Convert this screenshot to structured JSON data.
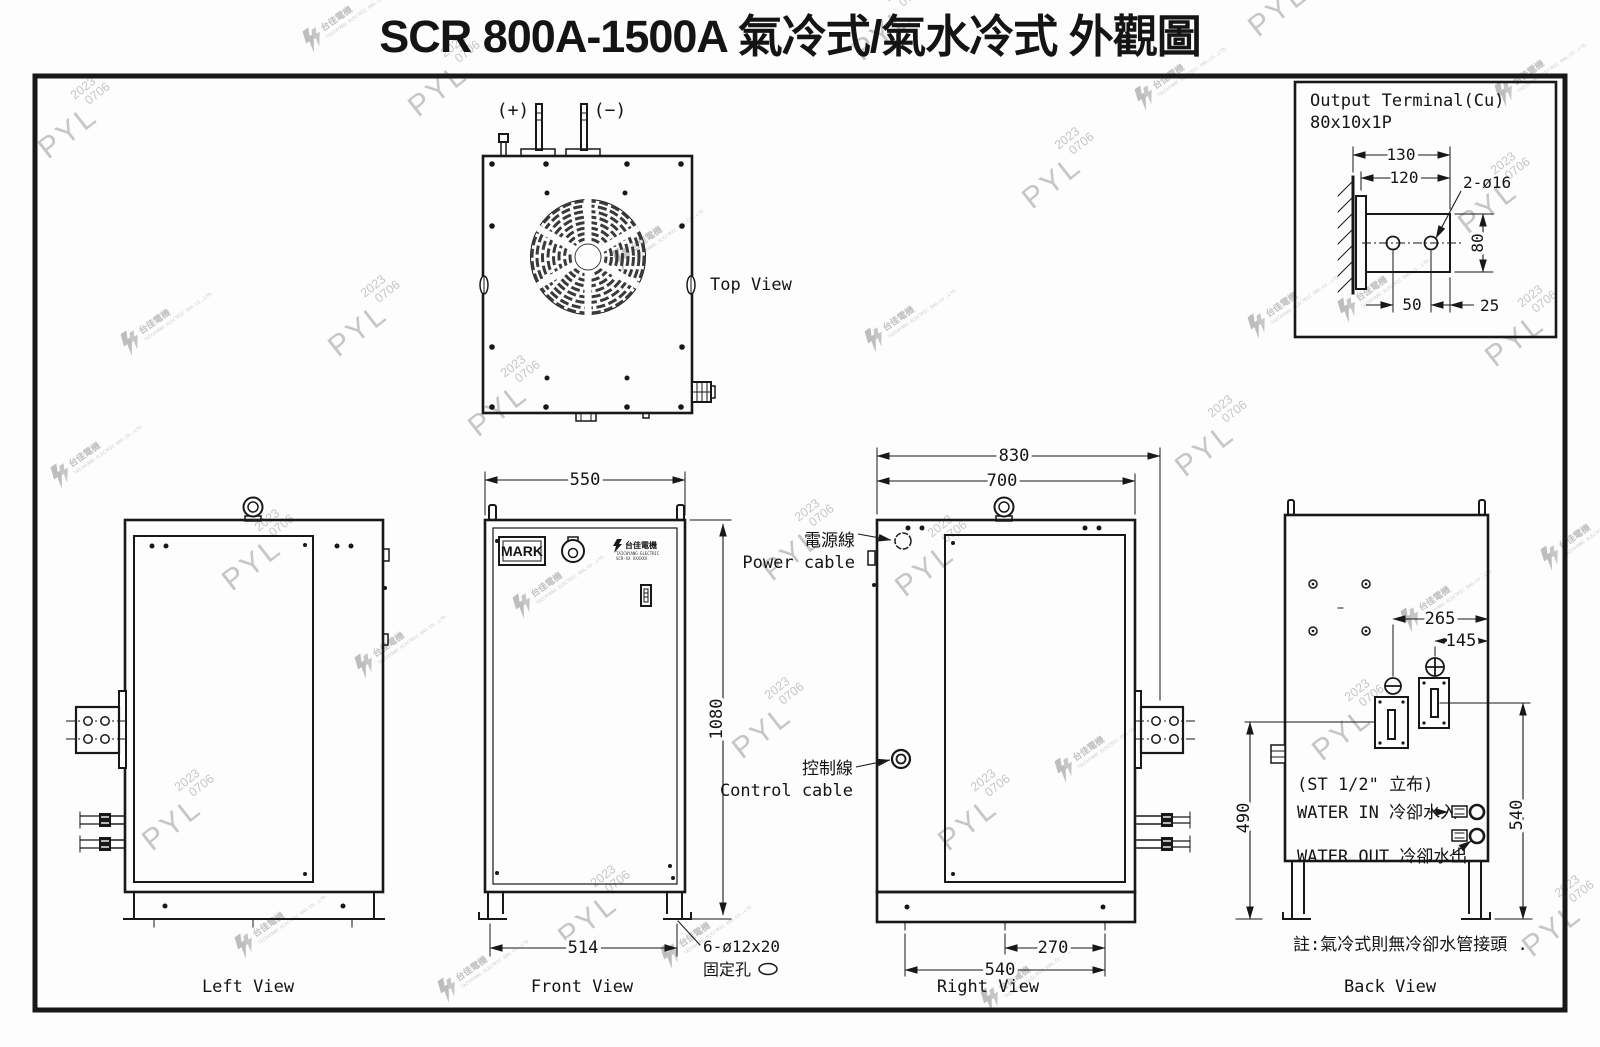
{
  "title": "SCR 800A-1500A 氣冷式/氣水冷式 外觀圖",
  "watermark": {
    "pyl": "PYL",
    "year": "2023",
    "date": "0706",
    "company_zh": "台佳電機",
    "company_en": "TAICHYANG ELECTRIC ENG.CO.,LTD."
  },
  "detail": {
    "title1": "Output Terminal(Cu)",
    "title2": "80x10x1P",
    "dim_130": "130",
    "dim_120": "120",
    "hole_label": "2-ø16",
    "dim_80": "80",
    "dim_50": "50",
    "dim_25": "25"
  },
  "top_view": {
    "label": "Top View",
    "plus": "(+)",
    "minus": "(−)"
  },
  "left_view": {
    "label": "Left View"
  },
  "front_view": {
    "label": "Front View",
    "mark": "MARK",
    "np_zh": "台佳電機",
    "np_l1": "TAICHYANG ELECTRIC",
    "np_l2": "SCR-XX XXXXXX",
    "dim_550": "550",
    "dim_1080": "1080",
    "dim_514": "514",
    "fix_1": "6-ø12x20",
    "fix_2": "固定孔"
  },
  "right_view": {
    "label": "Right View",
    "power_zh": "電源線",
    "power_en": "Power cable",
    "ctrl_zh": "控制線",
    "ctrl_en": "Control cable",
    "dim_830": "830",
    "dim_700": "700",
    "dim_270": "270",
    "dim_540": "540"
  },
  "back_view": {
    "label": "Back View",
    "dim_265": "265",
    "dim_145": "145",
    "dim_490": "490",
    "dim_540": "540",
    "st": "(ST 1/2\" 立布)",
    "win": "WATER IN 冷卻水入",
    "wout": "WATER OUT 冷卻水出",
    "note": "註:氣冷式則無冷卻水管接頭 ."
  }
}
